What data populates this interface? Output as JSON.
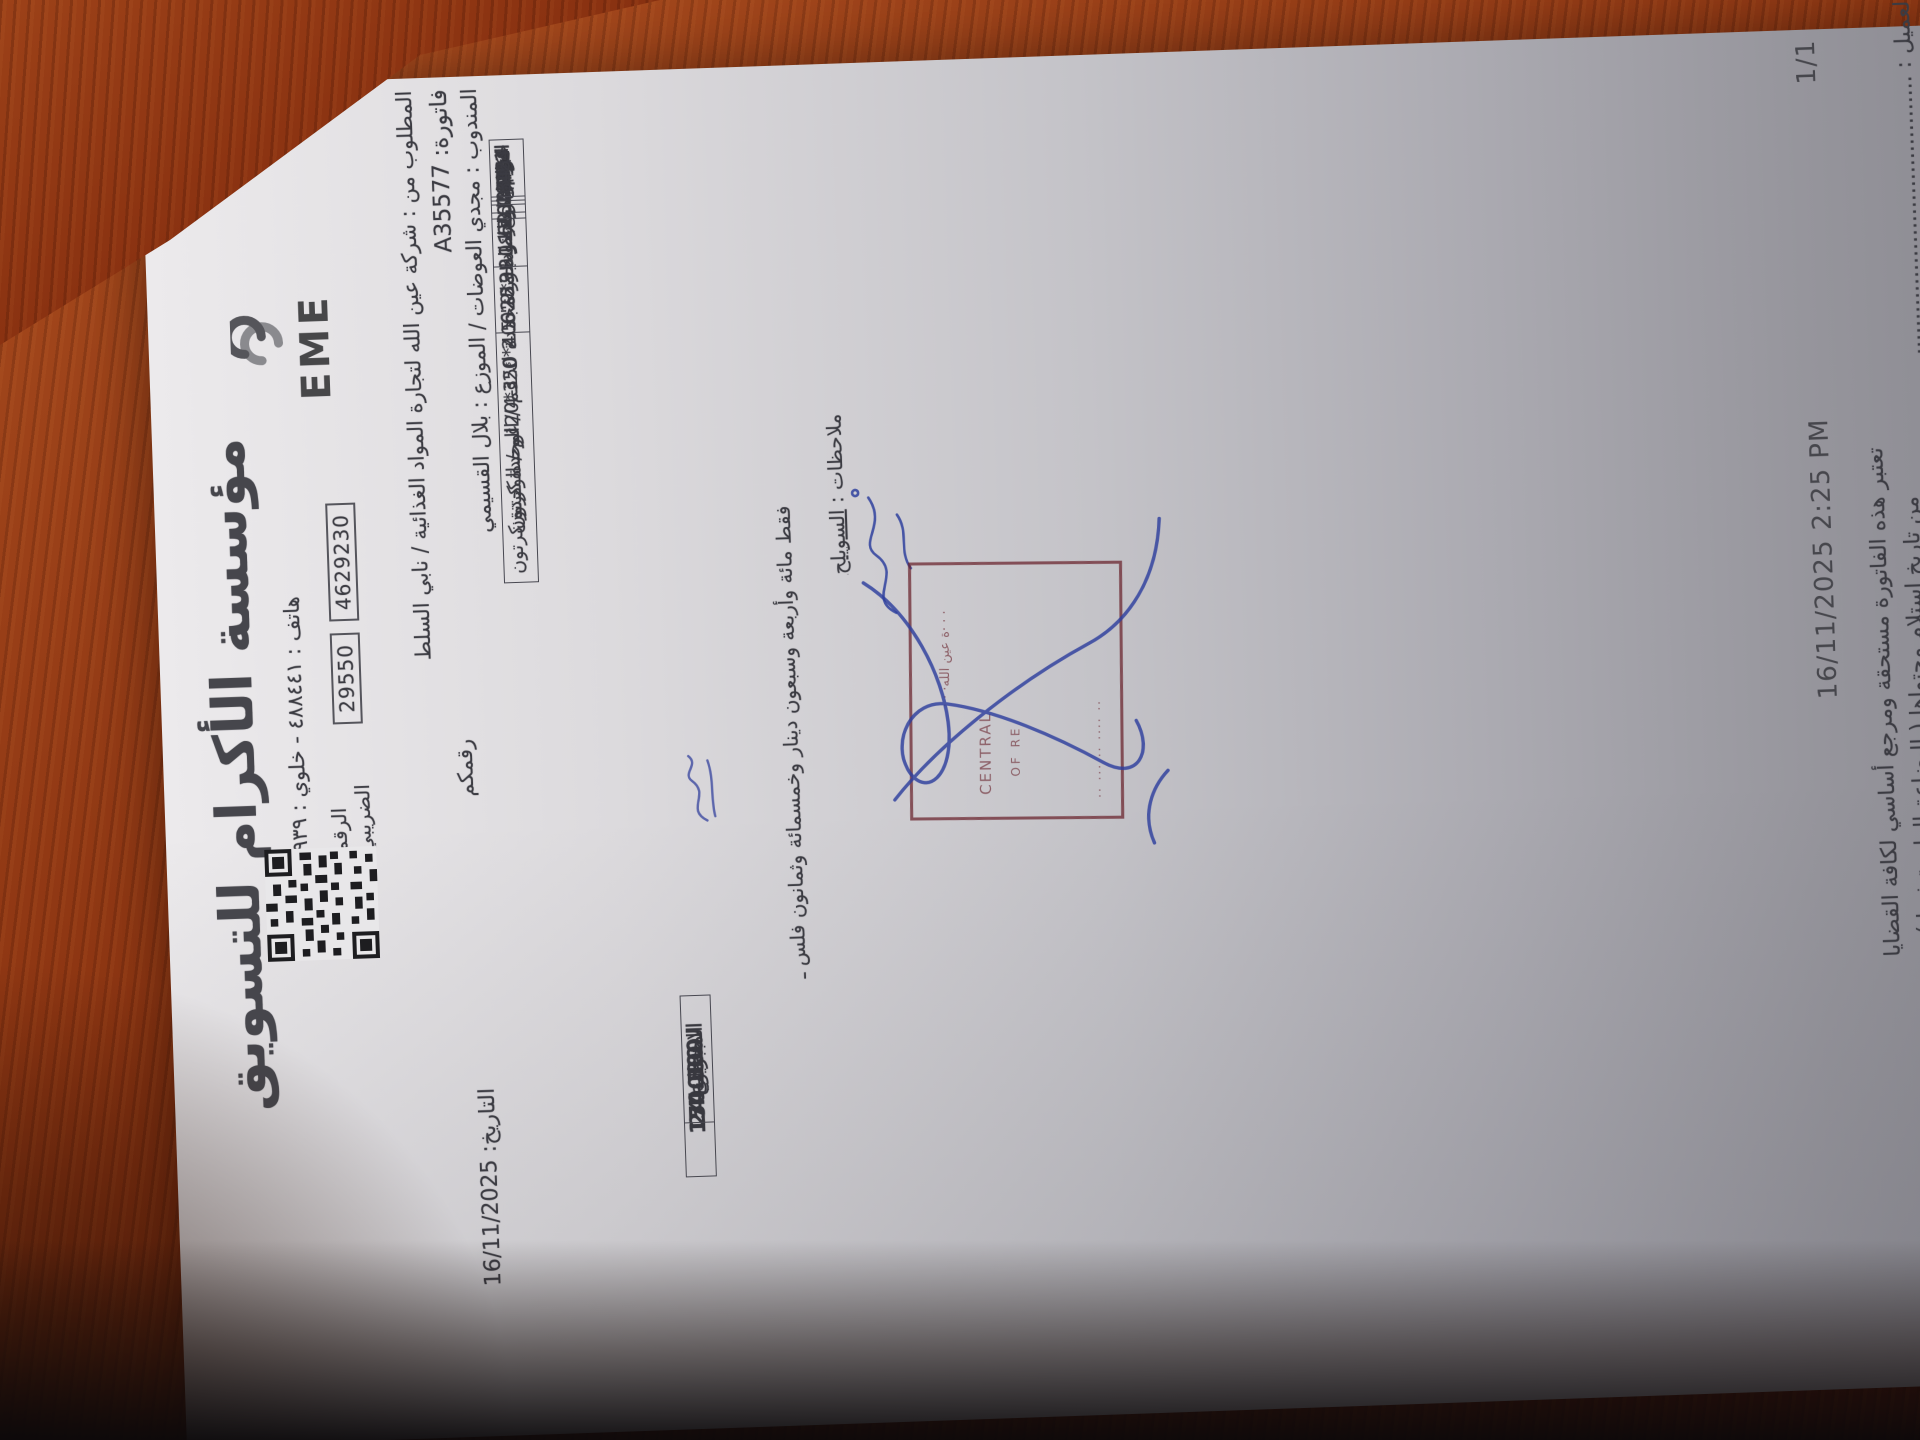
{
  "company": {
    "name": "مؤسسة الأكرام للتسويق",
    "phone_line": "هاتف : ٤٨٨٤٤١ - خلوي : ٠٧٩/٥٥٦١٢٩٣٩",
    "tax_label": "الرقم الضريبي",
    "tax_box_1": "29550",
    "tax_box_2": "4629230",
    "logo_word": "EME"
  },
  "info": {
    "bill_to": "المطلوب من : شركة عين الله لتجارة المواد الغذائية / نابي السلط",
    "invoice_line": "فاتورة: A35577",
    "your_no_label": "رقمكم",
    "date_line": "التاريخ: 16/11/2025",
    "rep_line": "المندوب : مجدي العوضات / الموزع : بلال القسيمي"
  },
  "table": {
    "headers": [
      "رقم",
      "با ركود",
      "المادة",
      "كمية",
      "بونص",
      "ضريبة",
      "السعر",
      "خصم%",
      "مجموع"
    ],
    "rows": [
      {
        "no": "1",
        "barcode": "6223001751007",
        "item": "امريكانا بطاطا \"9*9\" 2.5 ك 1-4 / الوحدة كرتون",
        "qty": "5",
        "bonus": "",
        "tax": "16",
        "price": "9.14",
        "disc": "",
        "total": "53.012"
      },
      {
        "no": "2",
        "barcode": "6253811200112",
        "item": "اكرام ملوخية مجمدة 400*20غم / الوحدة كرتون",
        "qty": "10",
        "bonus": "",
        "tax": "16",
        "price": "5.24",
        "disc": "",
        "total": "60.784"
      },
      {
        "no": "3",
        "barcode": "6253811200143",
        "item": "اكرام بازيلاء و جزر مجمدة 350*20غم / الوحدة كرتون",
        "qty": "10",
        "bonus": "",
        "tax": "16",
        "price": "5.24",
        "disc": "",
        "total": "60.784"
      }
    ]
  },
  "totals": {
    "sum_label": "المجموع",
    "sum_value": "150.500",
    "tax_label": "الضريبة",
    "tax_value": "24.080",
    "grand_label": "الاجمالي",
    "grand_value": "174.580"
  },
  "amount_in_words": "فقط مائة وأربعة وسبعون دينار وخمسمائة وثمانون فلس ـ",
  "notes": {
    "label": "ملاحظات :",
    "value": "السويلح"
  },
  "stamp": {
    "frag1": "· · ·ة عين الله· · ·",
    "frag2": "CENTRAL",
    "frag3": "OF RE",
    "frag4": "·· ··· ·· ···· ··"
  },
  "footer": {
    "timestamp": "16/11/2025 2:25 PM",
    "page": "1/1",
    "terms_line1": "تعتبر هذه الفاتورة مستحقة ومرجع أساسي لكافة القضايا",
    "terms_line2": "من تاريخ استلام محتواها ( البضاعة الواردة فيها )",
    "signature_label": "توقيع العميل :",
    "signature_dots": "........................................"
  },
  "colors": {
    "wood": "#86300f",
    "paper": "#d6d5d8",
    "ink": "#3b3b42",
    "stamp": "#68202a",
    "pen": "#2e3f9e"
  }
}
